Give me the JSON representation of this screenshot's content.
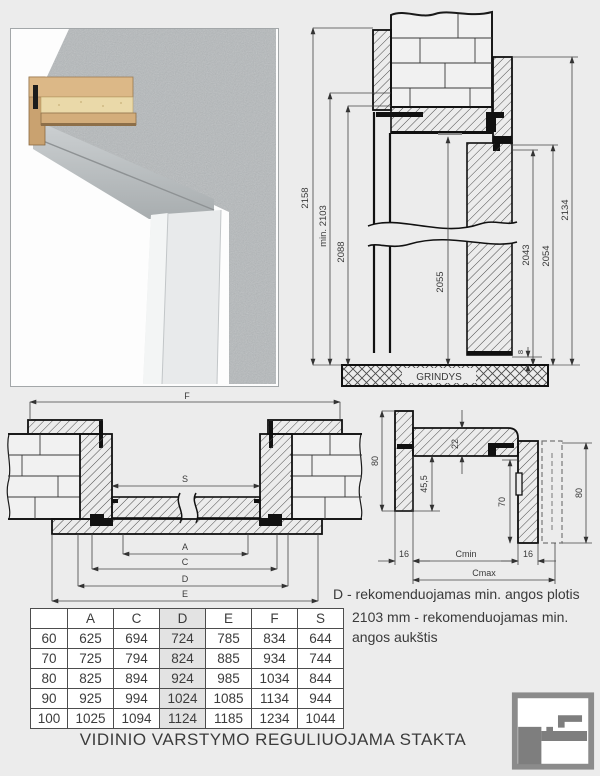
{
  "title": "VIDINIO VARSTYMO REGULIUOJAMA STAKTA",
  "notes": {
    "width_note": "D - rekomenduojamas min. angos plotis",
    "height_note": "2103 mm - rekomenduojamas min. angos aukštis"
  },
  "colors": {
    "background": "#ececec",
    "highlight_column": "#e3e3e3",
    "logo_gray": "#7e7e7e"
  },
  "vertical_section": {
    "floor_label": "GRINDYS",
    "dims": {
      "total_height": "2158",
      "min_opening_height": "min. 2103",
      "frame_outer_height": "2088",
      "door_leaf_height": "2055",
      "rebate_height": "2043",
      "clearance_height": "2054",
      "casing_height": "2134",
      "floor_gap": "8"
    }
  },
  "horizontal_section": {
    "dims": {
      "f": "F",
      "s": "S",
      "a": "A",
      "c": "C",
      "d": "D",
      "e": "E"
    }
  },
  "corner_detail": {
    "dims": {
      "casing_width_left": "80",
      "frame_board_thickness": "22",
      "rebate_depth": "45,5",
      "jamb_depth": "70",
      "casing_width_right": "80",
      "casing_overlap_left": "16",
      "wall_min": "Cmin",
      "casing_overlap_right": "16",
      "wall_max": "Cmax"
    }
  },
  "table": {
    "headers": [
      "",
      "A",
      "C",
      "D",
      "E",
      "F",
      "S"
    ],
    "highlight_header": "D",
    "rows": [
      [
        "60",
        "625",
        "694",
        "724",
        "785",
        "834",
        "644"
      ],
      [
        "70",
        "725",
        "794",
        "824",
        "885",
        "934",
        "744"
      ],
      [
        "80",
        "825",
        "894",
        "924",
        "985",
        "1034",
        "844"
      ],
      [
        "90",
        "925",
        "994",
        "1024",
        "1085",
        "1134",
        "944"
      ],
      [
        "100",
        "1025",
        "1094",
        "1124",
        "1185",
        "1234",
        "1044"
      ]
    ]
  }
}
